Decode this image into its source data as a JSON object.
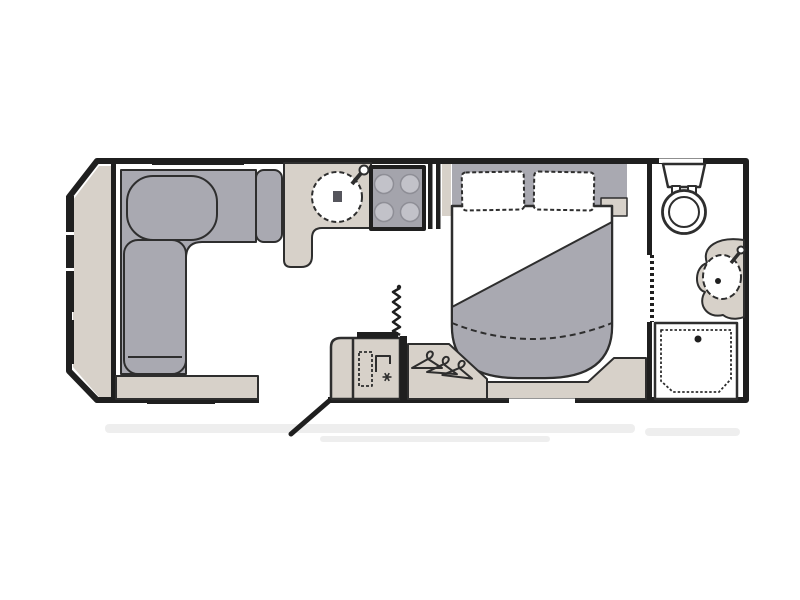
{
  "page": {
    "background": "#ffffff"
  },
  "colors": {
    "wall": "#1f1f1f",
    "outline": "#2e2e2e",
    "upholstery": "#a9a9b1",
    "counter": "#d7d1c9",
    "hob": "#a4a4ac",
    "burner": "#c2c2c9",
    "smudge": "#c9c9c9"
  },
  "floorplan": {
    "type": "caravan-floor-plan-top-view",
    "orientation": "hitch-end-left",
    "areas": [
      {
        "name": "front-lounge",
        "fixtures": [
          "front-shelf",
          "l-shaped-sofa",
          "front-window"
        ]
      },
      {
        "name": "kitchen",
        "fixtures": [
          "worktop",
          "round-sink",
          "tap",
          "hob-4-burner",
          "partition"
        ]
      },
      {
        "name": "mid-section",
        "fixtures": [
          "fridge-cabinet",
          "fridge-freezer-symbol",
          "heater-flue",
          "wardrobe",
          "coat-hangers",
          "entry-door"
        ]
      },
      {
        "name": "bedroom",
        "fixtures": [
          "double-bed",
          "pillow-left",
          "pillow-right",
          "duvet",
          "bedside-shelf",
          "bed-step"
        ]
      },
      {
        "name": "washroom",
        "fixtures": [
          "toilet",
          "washbasin",
          "basin-counter",
          "shower-tray",
          "sliding-door"
        ]
      }
    ]
  }
}
